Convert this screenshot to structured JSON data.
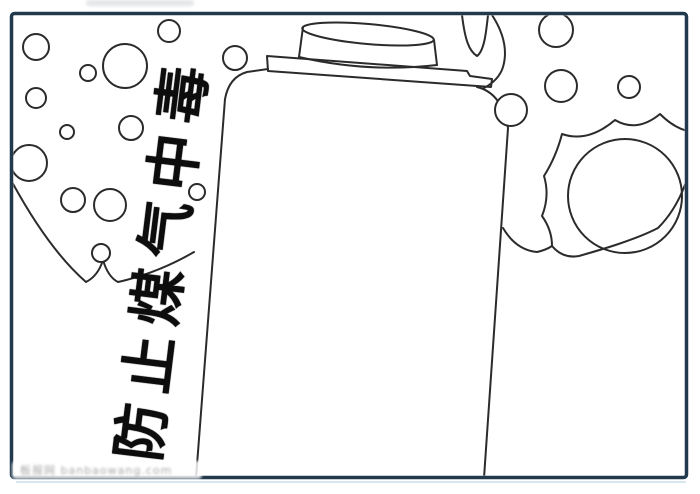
{
  "colors": {
    "paper": "#ffffff",
    "border": "#21394d",
    "line": "#2b2b2b",
    "title": "#0d0d0d",
    "watermark": "#a8a8a8",
    "underline": "#cfe0ec"
  },
  "title": {
    "text": "防止煤气中毒"
  },
  "watermark": {
    "text": "板报网 banbaowang.com"
  },
  "illustration": {
    "subject": "gas-canister-outline",
    "decorations": [
      "bubbles",
      "smoke-cloud-left",
      "starburst-blast-right",
      "smoke-curls-top"
    ]
  },
  "bubbles": [
    {
      "cx": 36,
      "cy": 47,
      "r": 13
    },
    {
      "cx": 88,
      "cy": 73,
      "r": 8
    },
    {
      "cx": 125,
      "cy": 66,
      "r": 22
    },
    {
      "cx": 169,
      "cy": 31,
      "r": 11
    },
    {
      "cx": 235,
      "cy": 58,
      "r": 12
    },
    {
      "cx": 36,
      "cy": 98,
      "r": 10
    },
    {
      "cx": 67,
      "cy": 132,
      "r": 7
    },
    {
      "cx": 131,
      "cy": 128,
      "r": 12
    },
    {
      "cx": 29,
      "cy": 163,
      "r": 18
    },
    {
      "cx": 73,
      "cy": 200,
      "r": 12
    },
    {
      "cx": 110,
      "cy": 205,
      "r": 16
    },
    {
      "cx": 101,
      "cy": 253,
      "r": 9
    },
    {
      "cx": 197,
      "cy": 192,
      "r": 8
    },
    {
      "cx": 556,
      "cy": 30,
      "r": 17
    },
    {
      "cx": 561,
      "cy": 86,
      "r": 16
    },
    {
      "cx": 629,
      "cy": 87,
      "r": 11
    },
    {
      "cx": 511,
      "cy": 110,
      "r": 16
    }
  ]
}
